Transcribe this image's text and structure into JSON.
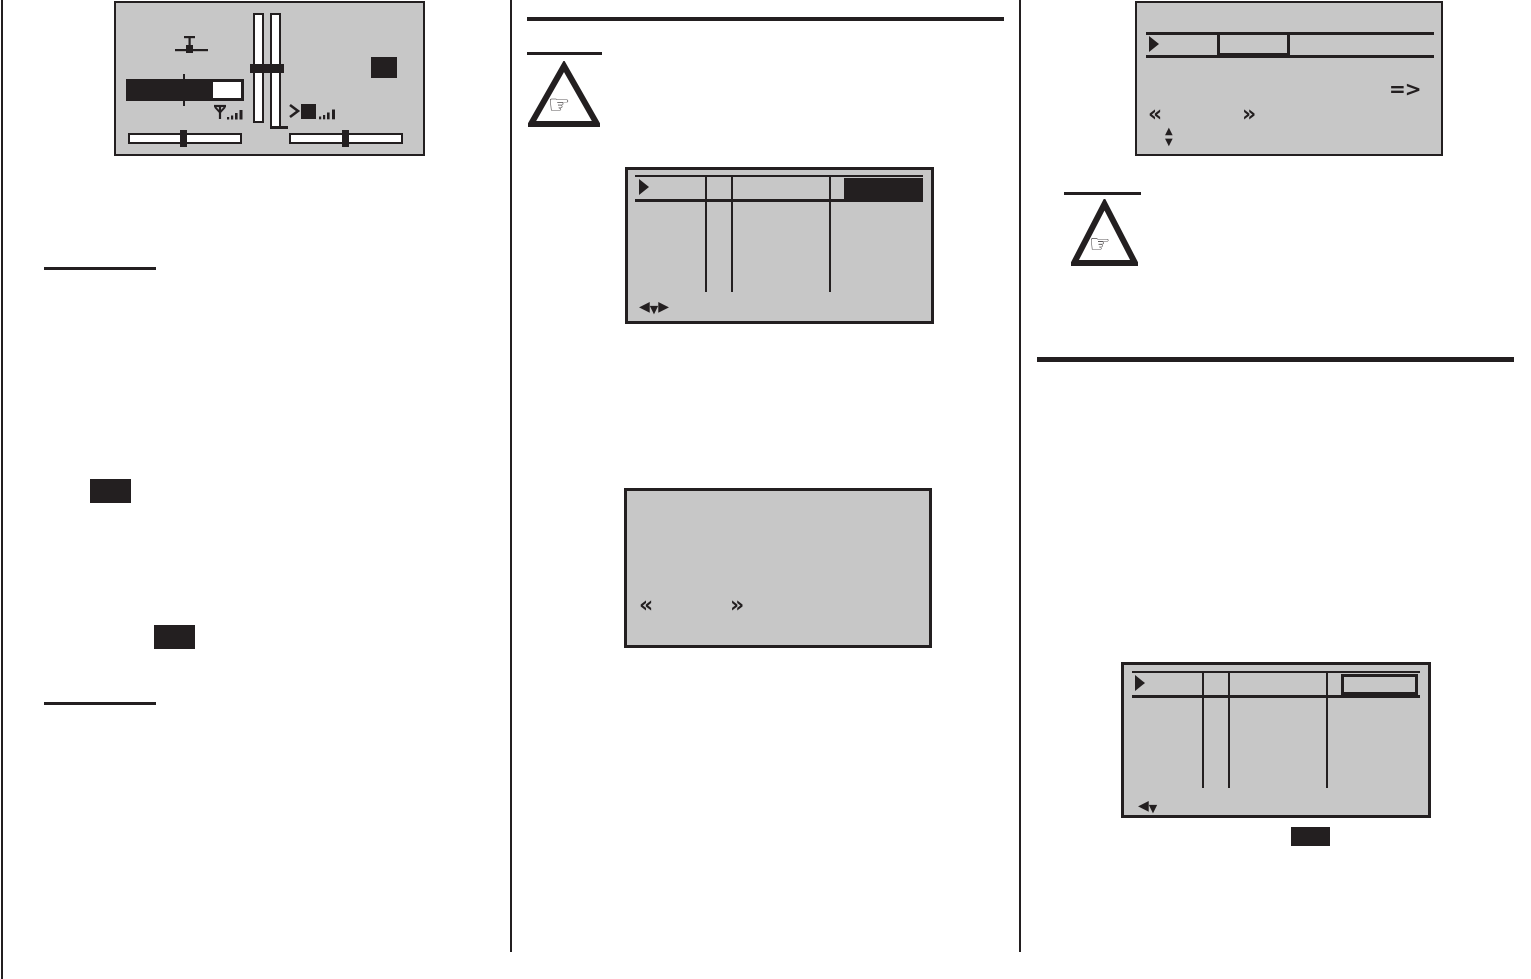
{
  "page": {
    "kind": "scanned-manual-page",
    "colors": {
      "paper": "#ffffff",
      "ink": "#231f20",
      "screen": "#c7c7c7"
    }
  },
  "glyphs": {
    "arrow_left": "◀",
    "arrow_down": "▼",
    "arrow_right": "▶",
    "arrow_up": "▲",
    "page_back": "«",
    "page_forward": "»",
    "store_arrow": "=>",
    "pointing_hand": "☞"
  }
}
